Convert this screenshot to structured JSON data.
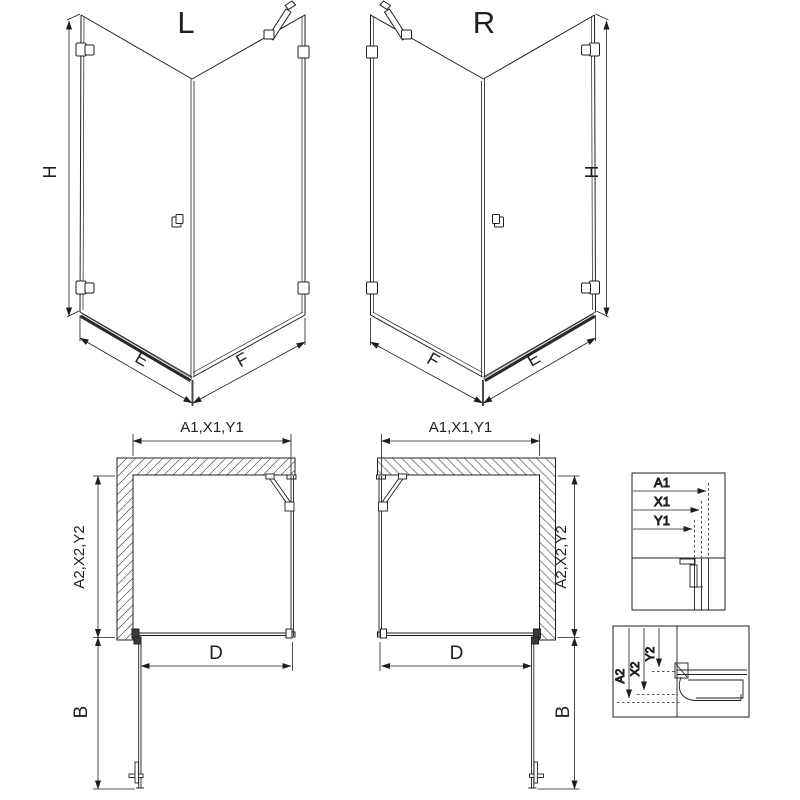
{
  "sheet": {
    "type": "shower-enclosure-technical-drawing",
    "colors": {
      "line": "#1f1f1f",
      "background": "#ffffff",
      "hatch": "#555555"
    }
  },
  "iso": {
    "left_label": "L",
    "right_label": "R",
    "dim_height": "H",
    "dim_door_side": "E",
    "dim_fixed_side": "F"
  },
  "plan": {
    "dim_top": "A1,X1,Y1",
    "dim_side": "A2,X2,Y2",
    "dim_opening": "D",
    "dim_door_swing": "B"
  },
  "details": {
    "top": {
      "a1": "A1",
      "x1": "X1",
      "y1": "Y1"
    },
    "bottom": {
      "a2": "A2",
      "x2": "X2",
      "y2": "Y2"
    }
  }
}
